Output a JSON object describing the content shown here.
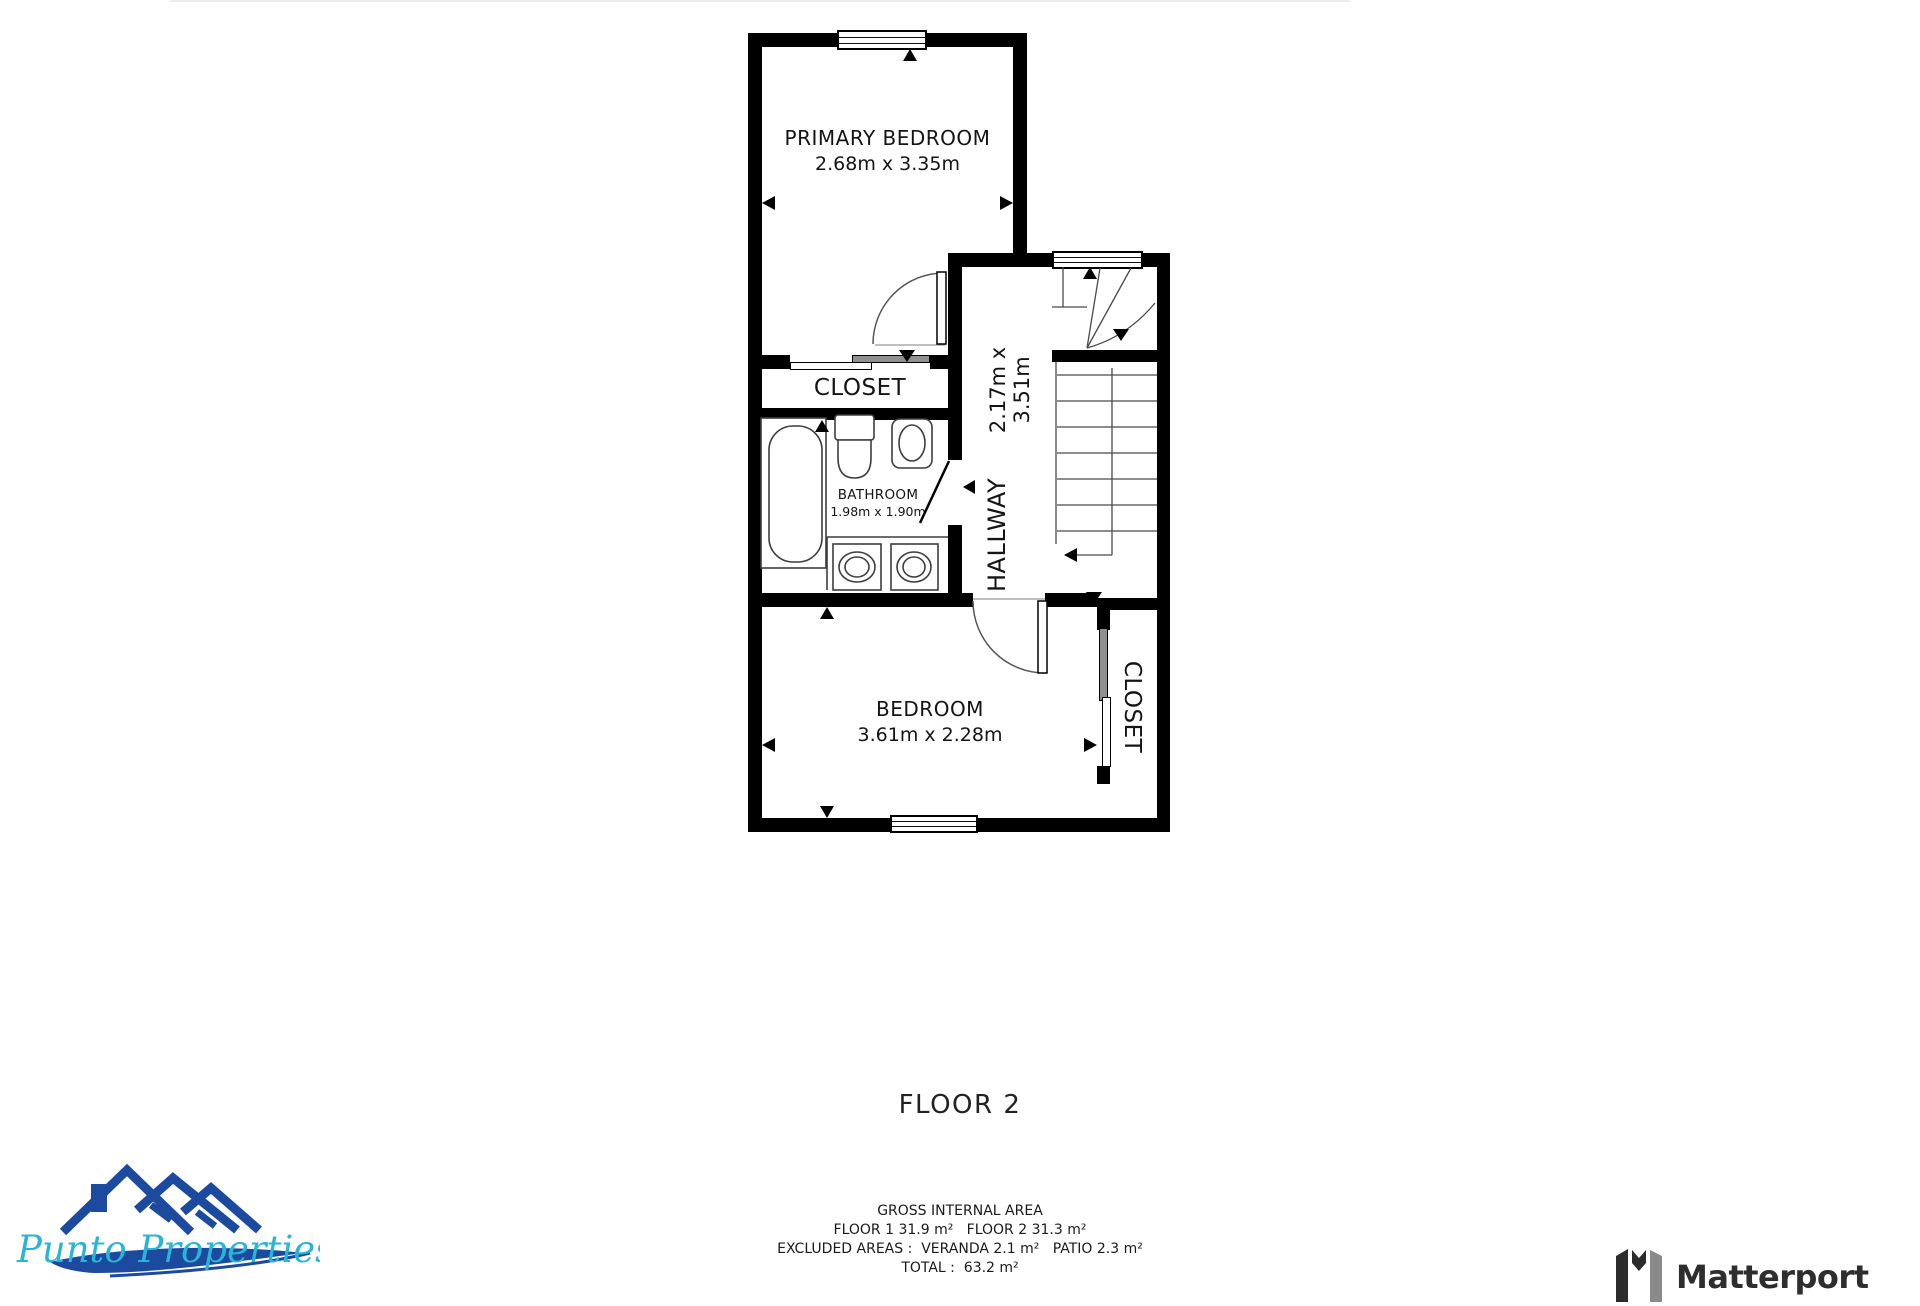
{
  "floorplan": {
    "floor_label": "FLOOR 2",
    "rooms": [
      {
        "name": "PRIMARY BEDROOM",
        "dims": "2.68m x 3.35m"
      },
      {
        "name": "CLOSET"
      },
      {
        "name": "BATHROOM",
        "dims": "1.98m x 1.90m"
      },
      {
        "name": "HALLWAY",
        "dims": "2.17m x 3.51m"
      },
      {
        "name": "BEDROOM",
        "dims": "3.61m x 2.28m"
      },
      {
        "name": "CLOSET"
      }
    ],
    "area_summary": {
      "title": "GROSS INTERNAL AREA",
      "floors_line": "FLOOR 1 31.9 m²   FLOOR 2 31.3 m²",
      "excluded_line": "EXCLUDED AREAS :  VERANDA 2.1 m²   PATIO 2.3 m²",
      "total_line": "TOTAL :  63.2 m²"
    },
    "colors": {
      "wall": "#000000",
      "linework": "#4a4a4a"
    }
  },
  "branding": {
    "agency_logo": {
      "name": "Punto Properties",
      "script_color": "#2ab5d6",
      "roof_color": "#1c4a9e"
    },
    "provider_logo": {
      "name": "Matterport",
      "color": "#2e2e2e"
    }
  }
}
